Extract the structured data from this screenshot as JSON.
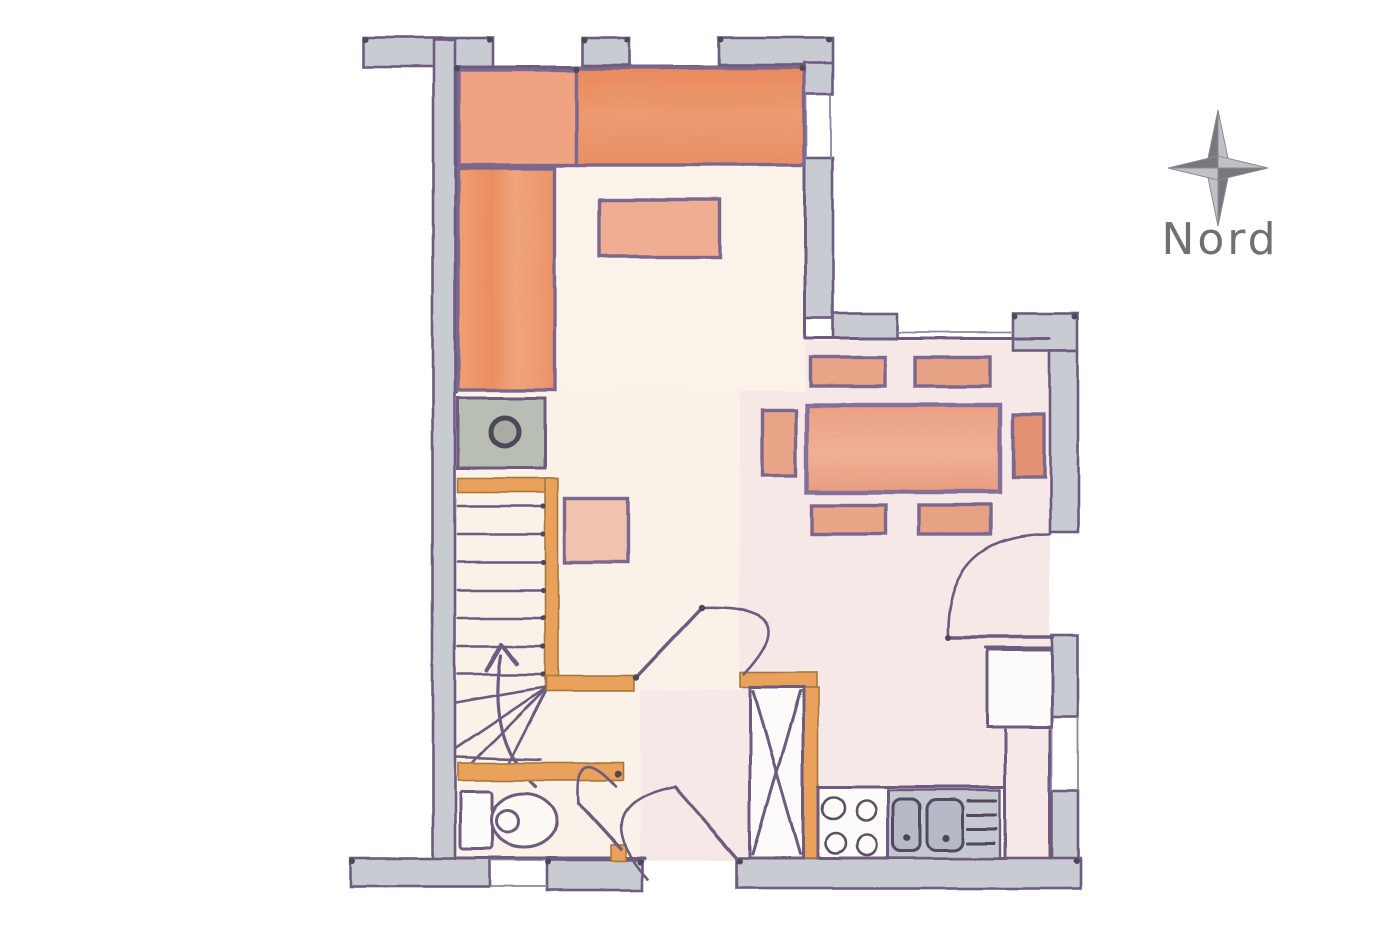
{
  "compass": {
    "label": "Nord",
    "icon": "compass-rose-icon"
  },
  "palette": {
    "background": "#ffffff",
    "wall_fill": "#c9cbd3",
    "wall_outline": "#6d5c7f",
    "furniture_outline": "#7b688e",
    "bed_orange": "#ea8f64",
    "bed_orange_light": "#f0a383",
    "closet_orange": "#ee9a6e",
    "shelf_salmon": "#efae93",
    "chest_pink": "#f2c2b0",
    "table_orange": "#e9a184",
    "chair_orange": "#eaa488",
    "stair_wood_orange": "#e9a15c",
    "appliance_gray": "#b9beb4",
    "sink_gray": "#c5c8d1",
    "floor_pink": "#f5e8e6",
    "floor_cream": "#f9efe2",
    "floor_bedroom": "#fbf2ea",
    "compass_dark": "#77777e",
    "compass_light": "#c0c0c6",
    "compass_text": "#6f6f75"
  },
  "inventory": {
    "type": "hand-drawn floor plan",
    "orientation_marker": "four-pointed compass rose with label at top right",
    "rooms": [
      "bedroom (top left: two orange beds, wardrobe, wall shelf)",
      "stair hall (winder staircase with up arrow, washing appliance with round door, small pink chest)",
      "wc (toilet with cistern)",
      "living-dining room (table with six chairs, window to north, door to east)",
      "kitchen (4-burner stove, double sink with drainboard, tall x-marked cabinet, fridge box)"
    ],
    "stairs": {
      "straight_treads": 7,
      "winder_treads": 4,
      "direction_arrow": "up"
    },
    "counts": {
      "stove_burners": 4,
      "sink_basins": 2,
      "dining_chairs": 6,
      "door_swings": 4,
      "beds": 2
    }
  }
}
